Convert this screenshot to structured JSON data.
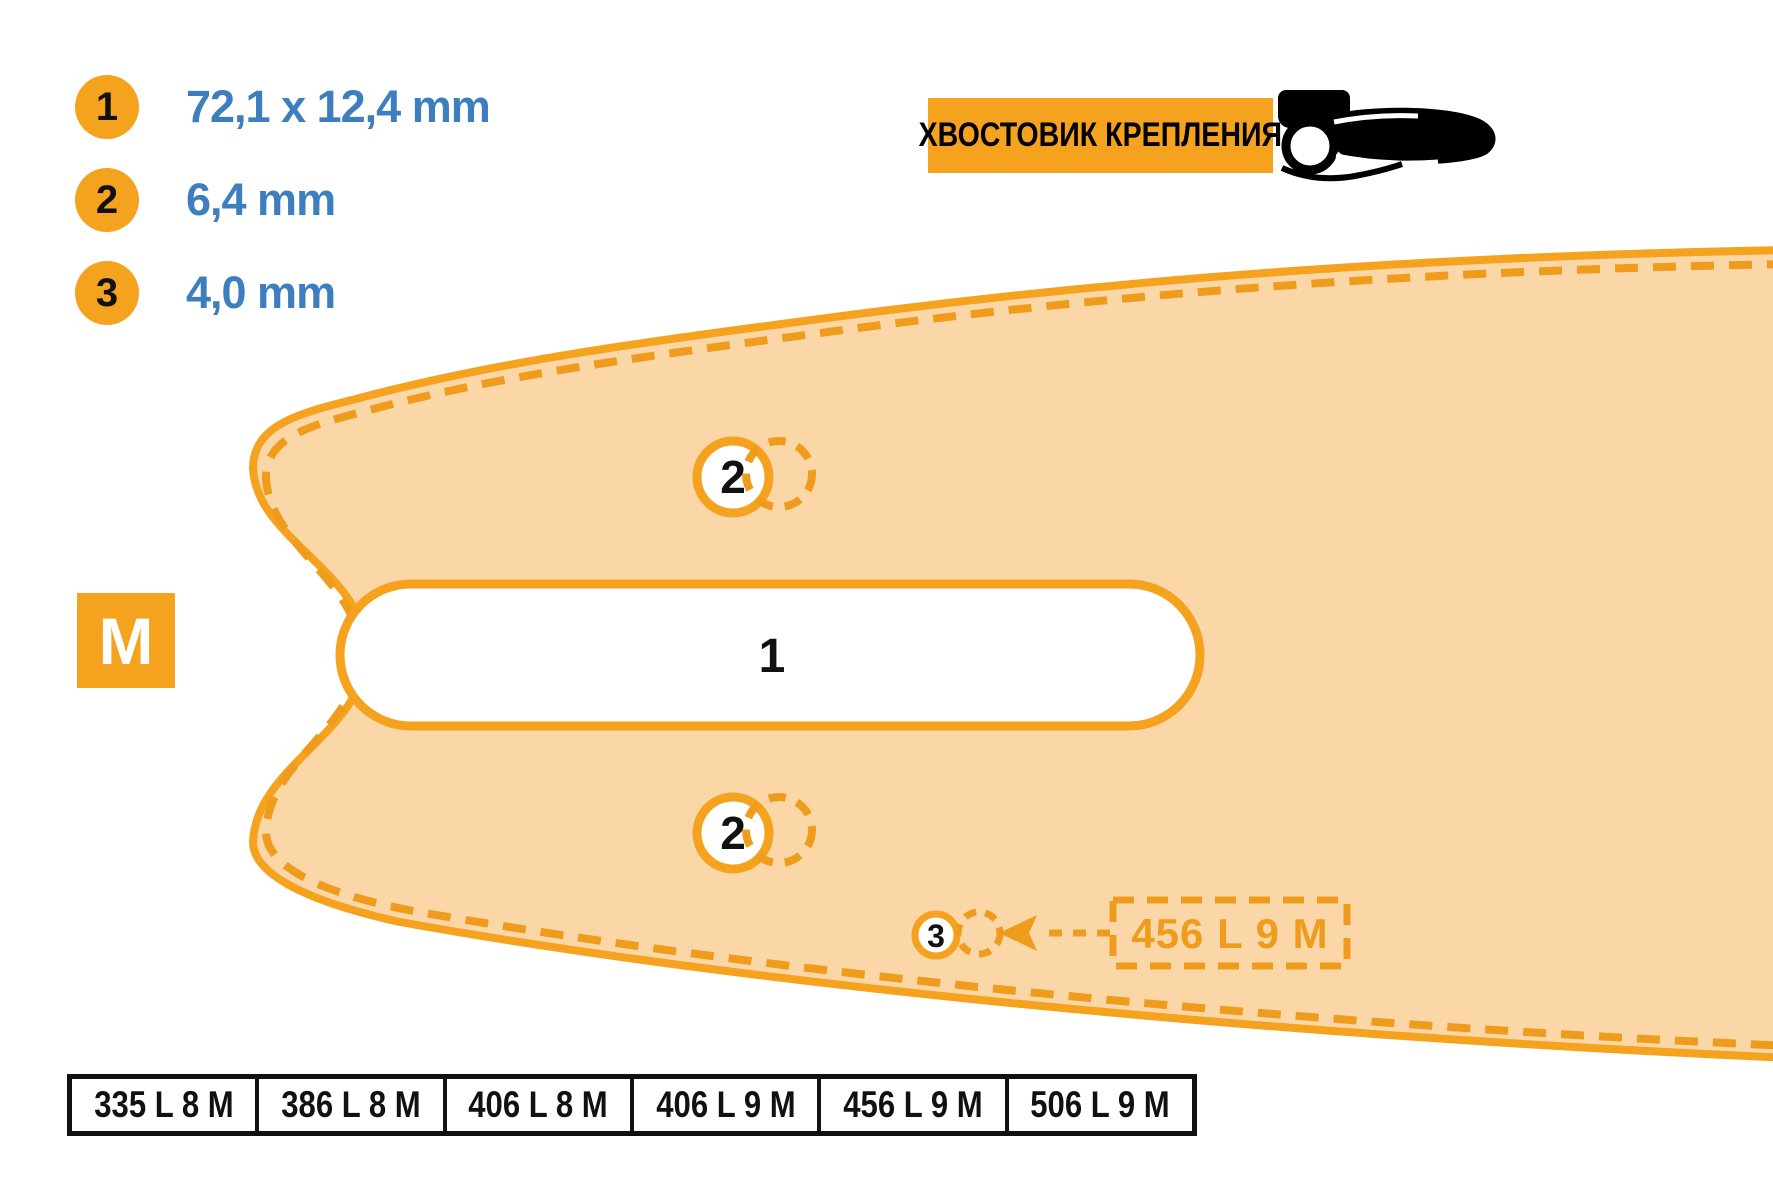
{
  "legend": {
    "items": [
      {
        "num": "1",
        "value": "72,1 x 12,4 mm"
      },
      {
        "num": "2",
        "value": "6,4 mm"
      },
      {
        "num": "3",
        "value": "4,0 mm"
      }
    ]
  },
  "header": {
    "title": "ХВОСТОВИК КРЕПЛЕНИЯ",
    "icon": "guide-bar-icon"
  },
  "badge": {
    "label": "M"
  },
  "diagram": {
    "slot_label": "1",
    "hole_top_label": "2",
    "hole_bottom_label": "2",
    "adjuster_label": "3",
    "callout": "456 L 9 M"
  },
  "table": {
    "cells": [
      "335 L 8 M",
      "386 L 8 M",
      "406 L 8 M",
      "406 L 9 M",
      "456 L 9 M",
      "506 L 9 M"
    ]
  },
  "colors": {
    "accent_orange": "#F5A21E",
    "dash_orange": "#EF9C1C",
    "bar_fill": "#FBD7A8",
    "value_blue": "#3D7EBE",
    "text_black": "#111111"
  }
}
